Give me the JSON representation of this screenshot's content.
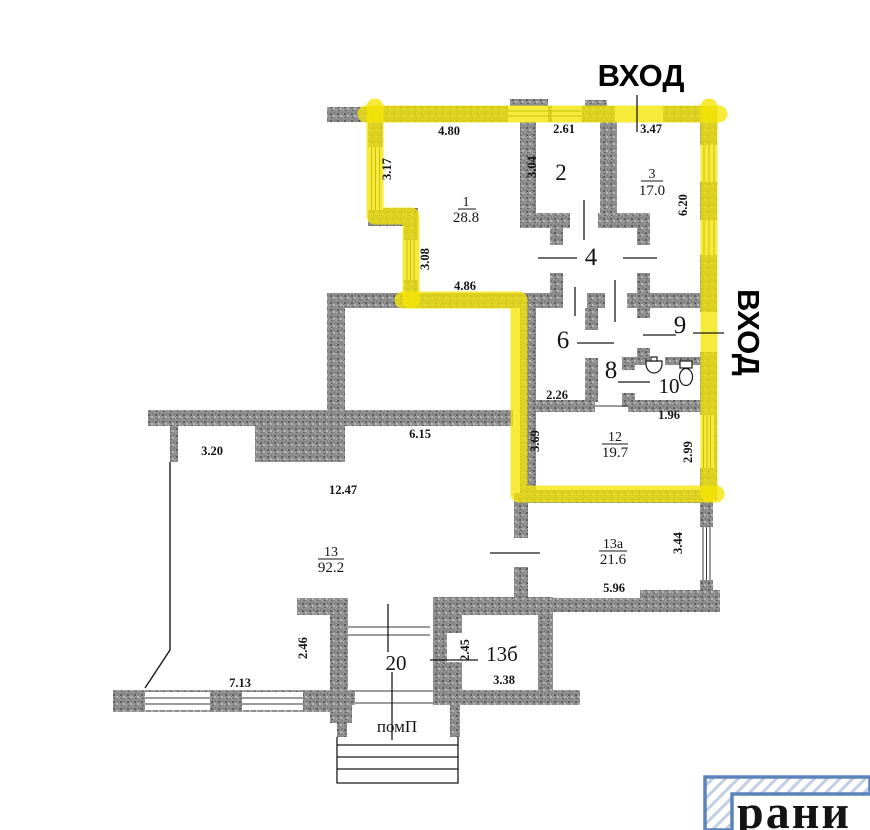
{
  "labels": {
    "entrance_top": "ВХОД",
    "entrance_right": "ВХОД",
    "porch": "помП",
    "logo": "рани"
  },
  "rooms": [
    {
      "number": "1",
      "area": "28.8"
    },
    {
      "number": "2"
    },
    {
      "number": "3",
      "area": "17.0"
    },
    {
      "number": "4"
    },
    {
      "number": "6"
    },
    {
      "number": "8"
    },
    {
      "number": "9"
    },
    {
      "number": "10"
    },
    {
      "number": "12",
      "area": "19.7"
    },
    {
      "number": "13",
      "area": "92.2"
    },
    {
      "number": "13а",
      "area": "21.6"
    },
    {
      "number": "13б"
    },
    {
      "number": "20"
    }
  ],
  "dims": [
    "4.80",
    "2.61",
    "3.47",
    "3.17",
    "3.04",
    "6.20",
    "3.08",
    "4.86",
    "2.26",
    "1.96",
    "3.69",
    "2.99",
    "6.15",
    "3.20",
    "12.47",
    "3.44",
    "5.96",
    "2.46",
    "2.45",
    "3.38",
    "7.13"
  ],
  "colors": {
    "highlight": "#f3e502",
    "wall_grey": "#8e8e8e",
    "logo_blue": "#5b84bb"
  }
}
